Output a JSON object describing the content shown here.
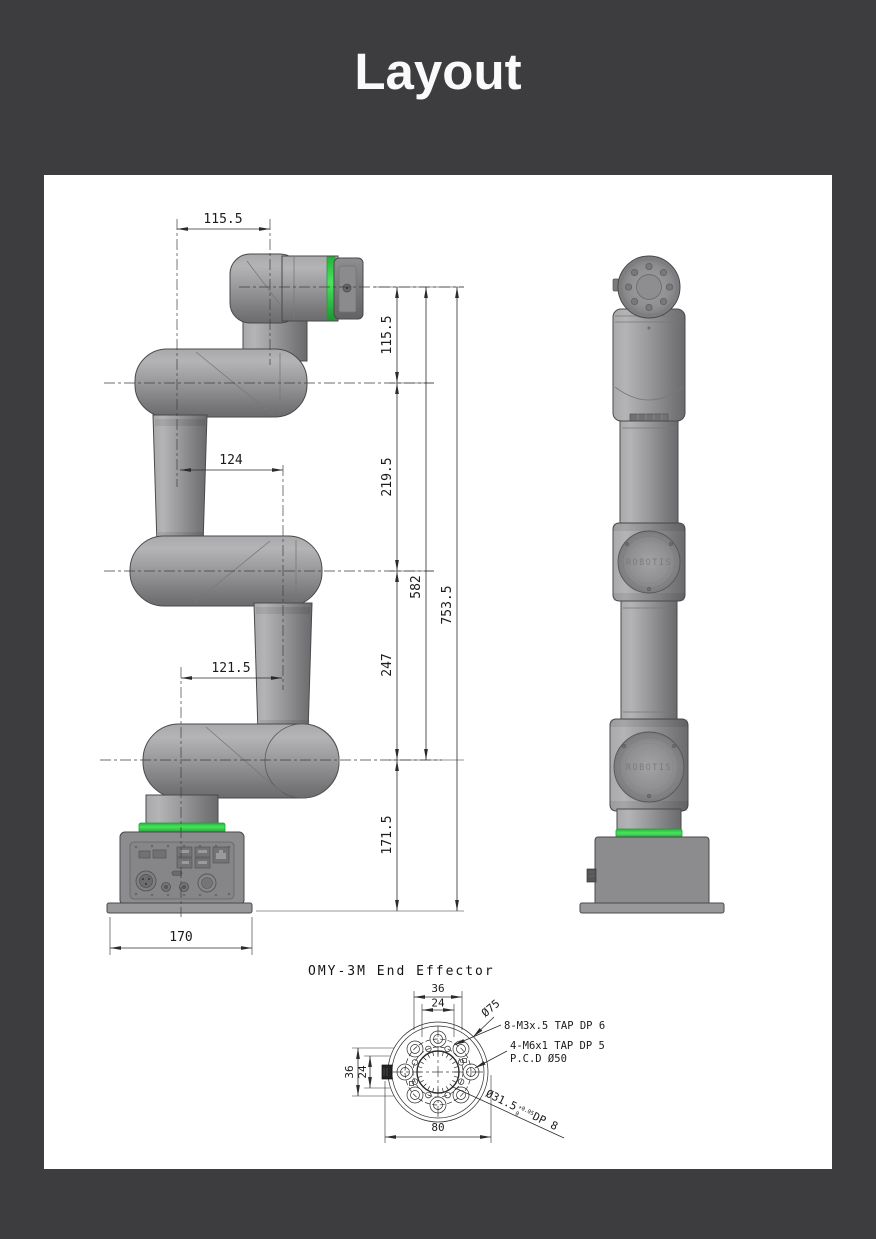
{
  "page": {
    "title": "Layout",
    "background": "#3d3d3f",
    "panel_background": "#ffffff"
  },
  "colors": {
    "accent_green": "#31d148",
    "robot_gray": "#929294",
    "outline": "#4a4a4c",
    "dimension_line": "#2b2b2b"
  },
  "side_view": {
    "dims": {
      "top_width": "115.5",
      "elbow_offset": "124",
      "base_offset": "121.5",
      "base_width": "170",
      "seg_wrist": "115.5",
      "seg_upper": "219.5",
      "seg_lower": "247",
      "seg_base": "171.5",
      "span_arm": "582",
      "span_total": "753.5"
    }
  },
  "front_view": {
    "logo": "ROBOTIS"
  },
  "end_effector": {
    "title": "OMY-3M End Effector",
    "dims": {
      "top_outer": "36",
      "top_inner": "24",
      "left_outer": "36",
      "left_inner": "24",
      "bottom": "80"
    },
    "labels": {
      "outer_dia": "Ø75",
      "m3": "8-M3x.5 TAP DP 6",
      "m6": "4-M6x1 TAP DP 5",
      "pcd": "P.C.D Ø50",
      "bore_dia": "Ø31.5",
      "bore_tol_up": "+0.05",
      "bore_tol_dn": "0",
      "bore_suffix": "DP 8"
    }
  }
}
